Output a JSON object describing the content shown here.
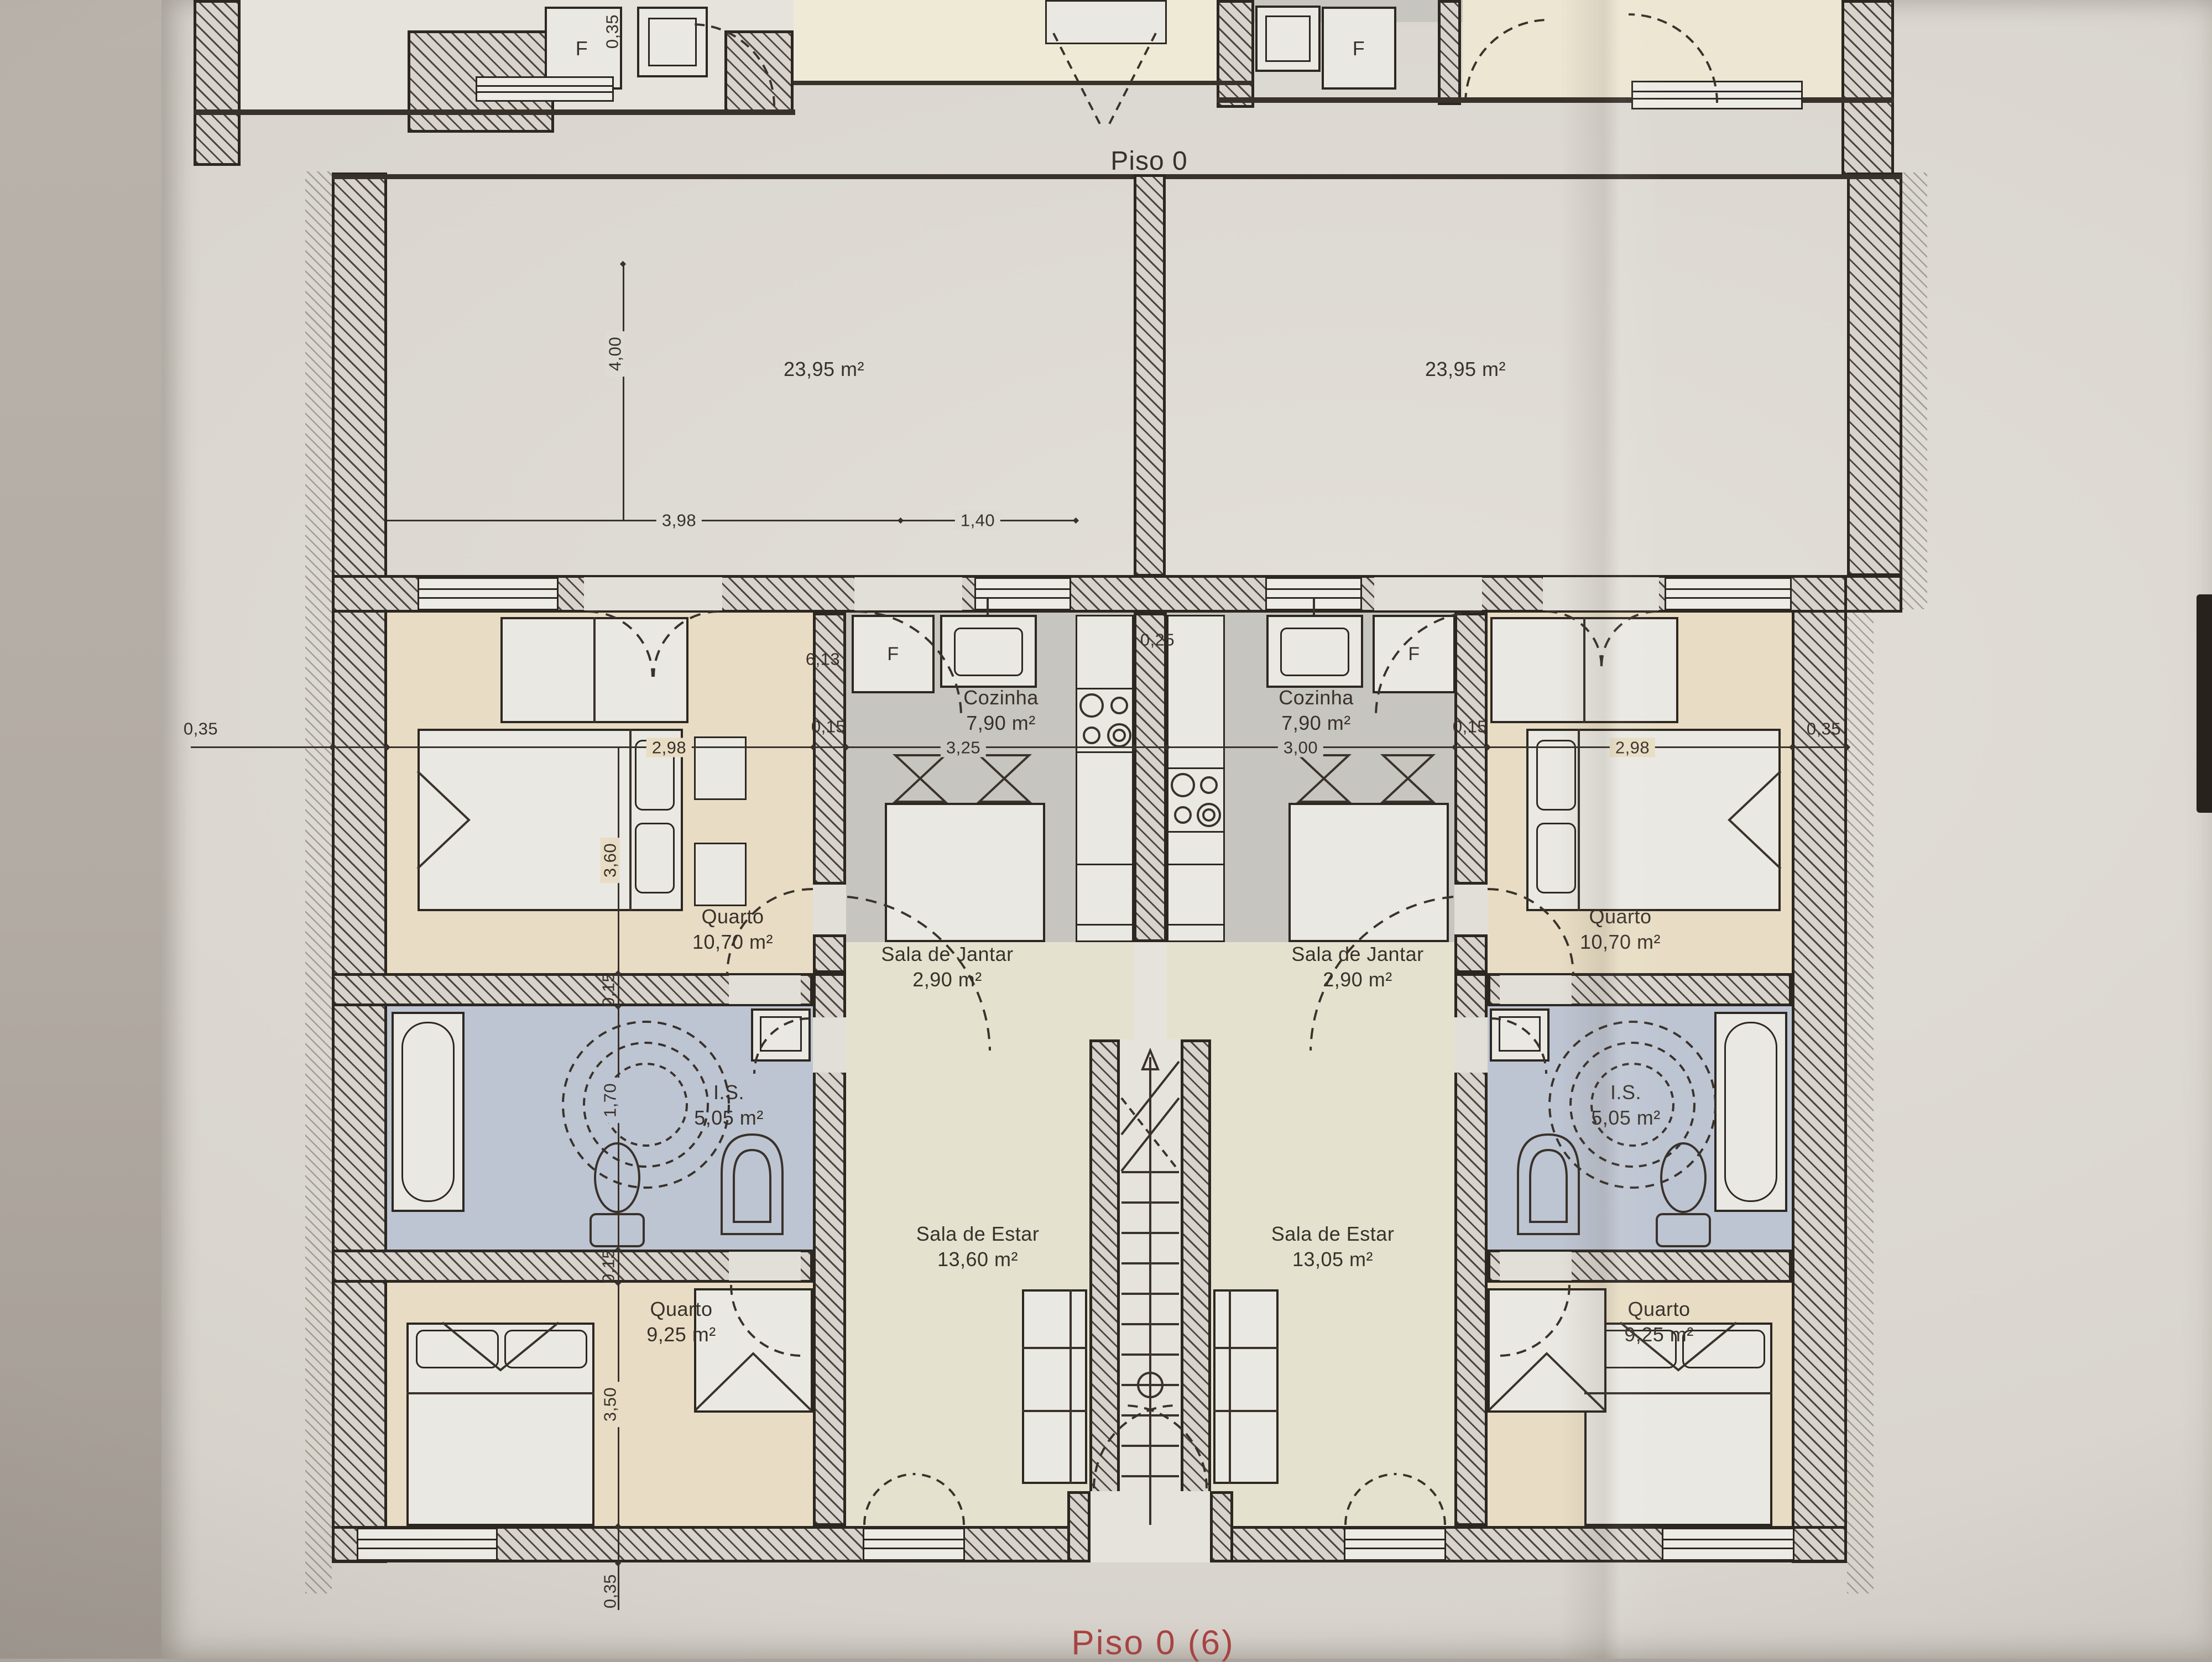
{
  "title": "Piso 0",
  "footer": "Piso 0 (6)",
  "terrace": {
    "left": "23,95 m²",
    "right": "23,95 m²"
  },
  "rooms": {
    "cozinha": "Cozinha",
    "cozinha_area": "7,90 m²",
    "quarto_grande": "Quarto",
    "quarto_grande_area": "10,70 m²",
    "jantar": "Sala de Jantar",
    "jantar_area": "2,90 m²",
    "is": "I.S.",
    "is_area": "5,05 m²",
    "quarto_pequeno": "Quarto",
    "quarto_pequeno_area": "9,25 m²",
    "estar": "Sala de Estar",
    "estar_left_area": "13,60 m²",
    "estar_right_area": "13,05 m²",
    "fridge": "F"
  },
  "dims": {
    "d035": "0,35",
    "d400": "4,00",
    "d398": "3,98",
    "d140": "1,40",
    "d613": "6,13",
    "d025": "0,25",
    "d298": "2,98",
    "d015": "0,15",
    "d325": "3,25",
    "d300": "3,00",
    "d360": "3,60",
    "d170": "1,70",
    "d350": "3,50"
  }
}
